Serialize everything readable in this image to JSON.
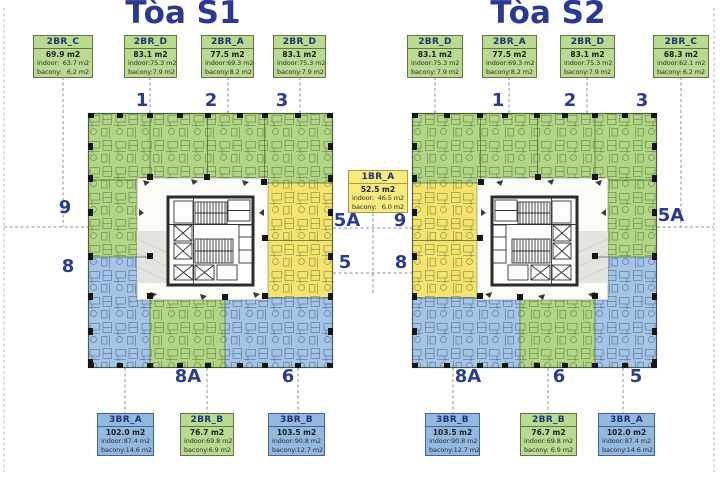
{
  "towers": [
    {
      "title": "Tòa S1",
      "top_units": [
        {
          "code": "2BR_C",
          "total": "69.9 m2",
          "indoor": "63.7 m2",
          "balcony": "6.2 m2"
        },
        {
          "code": "2BR_D",
          "total": "83.1 m2",
          "indoor": "75.3 m2",
          "balcony": "7.9 m2"
        },
        {
          "code": "2BR_A",
          "total": "77.5 m2",
          "indoor": "69.3 m2",
          "balcony": "8.2 m2"
        },
        {
          "code": "2BR_D",
          "total": "83.1 m2",
          "indoor": "75.3 m2",
          "balcony": "7.9 m2"
        }
      ],
      "bottom_units": [
        {
          "code": "3BR_A",
          "total": "102.0 m2",
          "indoor": "87.4 m2",
          "balcony": "14.6 m2"
        },
        {
          "code": "2BR_B",
          "total": "76.7 m2",
          "indoor": "69.8 m2",
          "balcony": "6.9 m2"
        },
        {
          "code": "3BR_B",
          "total": "103.5 m2",
          "indoor": "90.8 m2",
          "balcony": "12.7 m2"
        }
      ],
      "numbers": {
        "top": [
          "1",
          "2",
          "3"
        ],
        "left": [
          "9",
          "8"
        ],
        "right": [
          "5A",
          "5"
        ],
        "bottom": [
          "8A",
          "6"
        ]
      }
    },
    {
      "title": "Tòa S2",
      "top_units": [
        {
          "code": "2BR_D",
          "total": "83.1 m2",
          "indoor": "75.3 m2",
          "balcony": "7.9 m2"
        },
        {
          "code": "2BR_A",
          "total": "77.5 m2",
          "indoor": "69.3 m2",
          "balcony": "8.2 m2"
        },
        {
          "code": "2BR_D",
          "total": "83.1 m2",
          "indoor": "75.3 m2",
          "balcony": "7.9 m2"
        },
        {
          "code": "2BR_C",
          "total": "68.3 m2",
          "indoor": "62.1 m2",
          "balcony": "6.2 m2"
        }
      ],
      "bottom_units": [
        {
          "code": "3BR_B",
          "total": "103.5 m2",
          "indoor": "90.8 m2",
          "balcony": "12.7 m2"
        },
        {
          "code": "2BR_B",
          "total": "76.7 m2",
          "indoor": "69.8 m2",
          "balcony": "6.9 m2"
        },
        {
          "code": "3BR_A",
          "total": "102.0 m2",
          "indoor": "87.4 m2",
          "balcony": "14.6 m2"
        }
      ],
      "numbers": {
        "top": [
          "1",
          "2",
          "3"
        ],
        "left": [
          "9",
          "8"
        ],
        "right": [
          "5A"
        ],
        "bottom": [
          "8A",
          "6",
          "5"
        ]
      }
    }
  ],
  "center_unit": {
    "code": "1BR_A",
    "total": "52.5 m2",
    "indoor": "46.5 m2",
    "balcony": "6.0 m2"
  },
  "labels": {
    "indoor": "indoor:",
    "balcony": "bacony:"
  },
  "colors": {
    "title_navy": "#2b3990",
    "number_navy": "#2b3c8f",
    "card_green": "#b9da90",
    "card_blue": "#93b9e0",
    "card_yellow": "#f8ea7e",
    "plan_green": "#b3d586",
    "plan_yellow": "#f4e46f",
    "plan_blue": "#a6c4e5"
  }
}
